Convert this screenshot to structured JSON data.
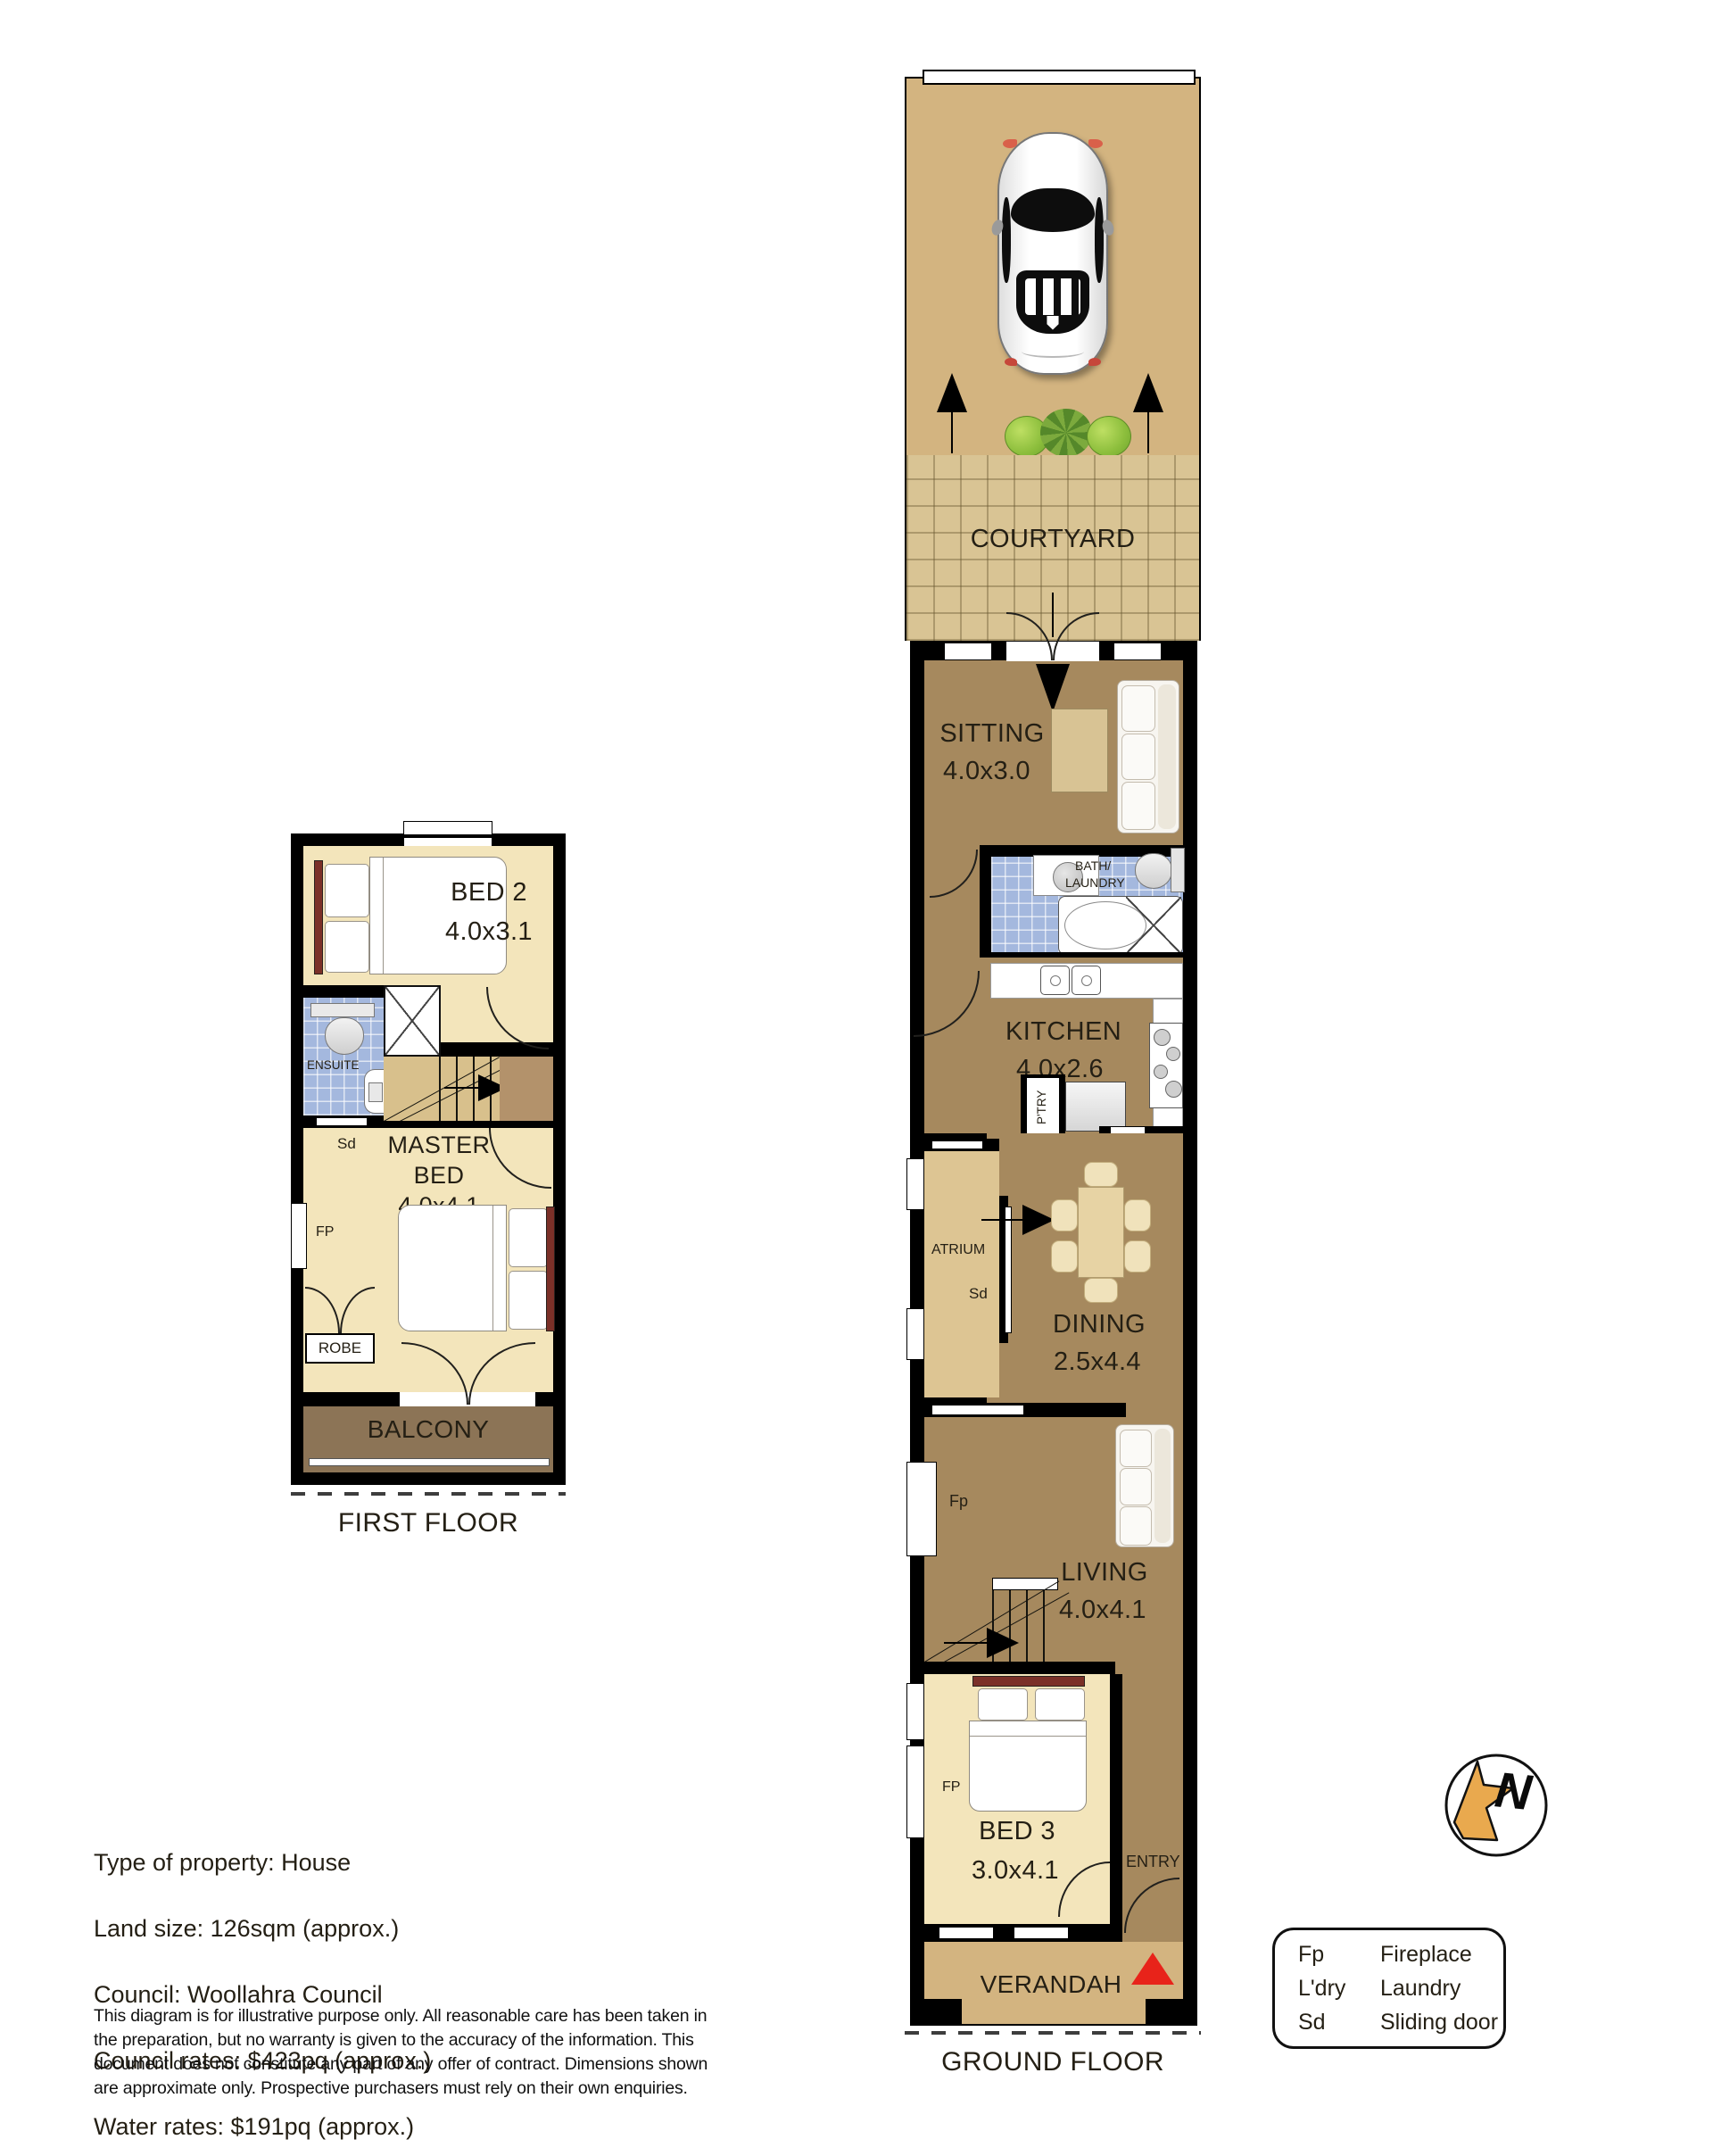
{
  "colors": {
    "wall": "#000000",
    "tan": "#D3B480",
    "courtyard_tan": "#D9C494",
    "floor_brown": "#A6895E",
    "atrium_tan": "#DDC593",
    "stairs_tan": "#D8C08C",
    "landing_brown": "#B3926B",
    "floor_cream": "#F3E5BB",
    "tile_blue": "#A4B8DE",
    "balcony_brown": "#8C7456",
    "rug_tan": "#D8C394",
    "table_tan": "#E7D3A4",
    "chair_cream": "#F0E2BB",
    "marker_red": "#E8231A",
    "compass_gold": "#E9A94E",
    "headboard_red": "#7B3028"
  },
  "ground_floor": {
    "floor_label": "GROUND FLOOR",
    "courtyard": "COURTYARD",
    "sitting": {
      "name": "SITTING",
      "dim": "4.0x3.0"
    },
    "bath": {
      "line1": "BATH/",
      "line2": "LAUNDRY"
    },
    "kitchen": {
      "name": "KITCHEN",
      "dim": "4.0x2.6"
    },
    "pantry": "P'TRY",
    "fp_kitchen": "FP",
    "atrium": "ATRIUM",
    "sd_atrium": "Sd",
    "dining": {
      "name": "DINING",
      "dim": "2.5x4.4"
    },
    "fp_living": "Fp",
    "living": {
      "name": "LIVING",
      "dim": "4.0x4.1"
    },
    "bed3": {
      "name": "BED 3",
      "dim": "3.0x4.1"
    },
    "fp_bed3": "FP",
    "entry": "ENTRY",
    "verandah": "VERANDAH"
  },
  "first_floor": {
    "floor_label": "FIRST FLOOR",
    "bed2": {
      "name": "BED 2",
      "dim": "4.0x3.1"
    },
    "ensuite": "ENSUITE",
    "sd_ensuite": "Sd",
    "master": {
      "line1": "MASTER",
      "line2": "BED",
      "dim": "4.0x4.1"
    },
    "fp_master": "FP",
    "robe": "ROBE",
    "balcony": "BALCONY"
  },
  "property": {
    "lines": [
      "Type of property: House",
      "Land size: 126sqm (approx.)",
      "Council: Woollahra Council",
      "Council rates: $423pq (approx.)",
      "Water rates: $191pq (approx.)"
    ]
  },
  "disclaimer": "This diagram is for illustrative purpose only. All reasonable care has been taken in the preparation, but no warranty is given to the accuracy of the information. This document does not constitute any part of any offer of contract. Dimensions shown are approximate only. Prospective purchasers must rely on their own enquiries.",
  "legend": {
    "rows": [
      {
        "abbr": "Fp",
        "meaning": "Fireplace"
      },
      {
        "abbr": "L'dry",
        "meaning": "Laundry"
      },
      {
        "abbr": "Sd",
        "meaning": "Sliding door"
      }
    ]
  },
  "compass": {
    "letter": "N"
  }
}
